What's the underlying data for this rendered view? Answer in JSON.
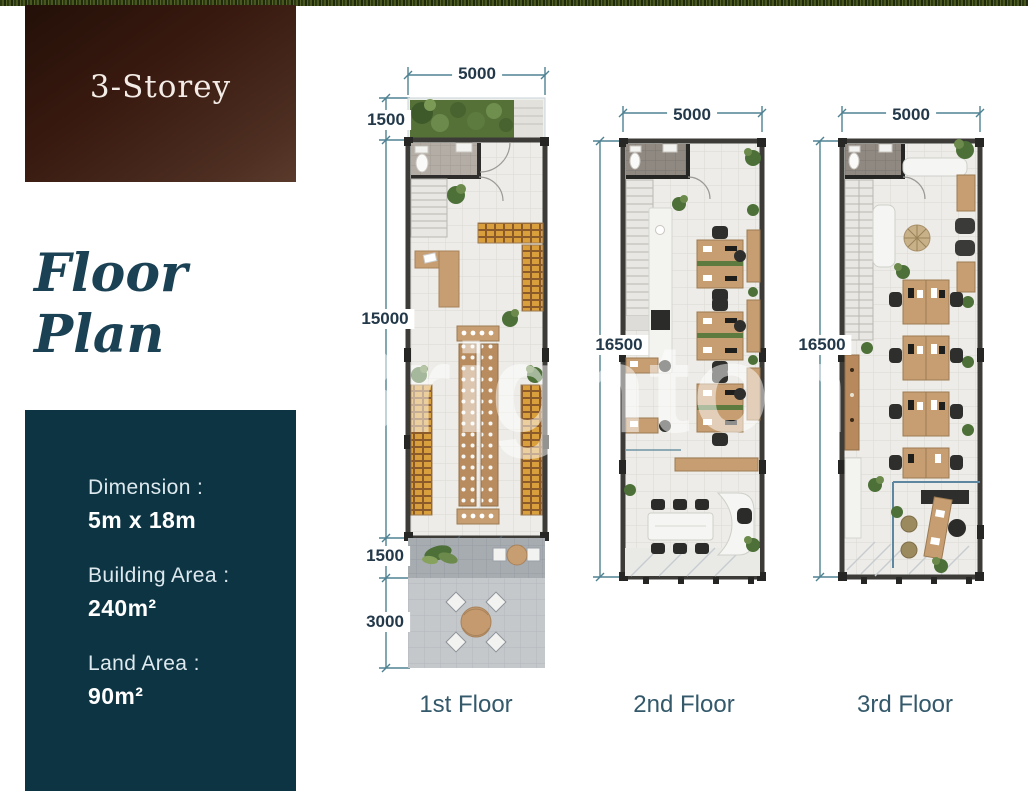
{
  "badge": {
    "title": "3-Storey"
  },
  "heading": {
    "title": "Floor Plan"
  },
  "specs": {
    "items": [
      {
        "label": "Dimension :",
        "value": "5m x 18m"
      },
      {
        "label": "Building Area :",
        "value": "240m²"
      },
      {
        "label": "Land Area :",
        "value": "90m²"
      }
    ]
  },
  "watermark": {
    "text": "Brighton"
  },
  "plans": [
    {
      "label": "1st Floor",
      "dims": {
        "width": "5000",
        "left": [
          "1500",
          "15000",
          "1500",
          "3000"
        ]
      }
    },
    {
      "label": "2nd Floor",
      "dims": {
        "width": "5000",
        "left": [
          "16500"
        ]
      }
    },
    {
      "label": "3rd Floor",
      "dims": {
        "width": "5000",
        "left": [
          "16500"
        ]
      }
    }
  ],
  "palette": {
    "teal_box": "#0d3443",
    "dim_text": "#23394a",
    "dim_line": "#4e8292",
    "floor_label_teal": "#33596b",
    "heading_teal": "#1b4254",
    "badge_brown_dark": "#231008",
    "badge_brown_light": "#5a3a2b",
    "wood": "#c79e72",
    "wall": "#3c3b38"
  }
}
